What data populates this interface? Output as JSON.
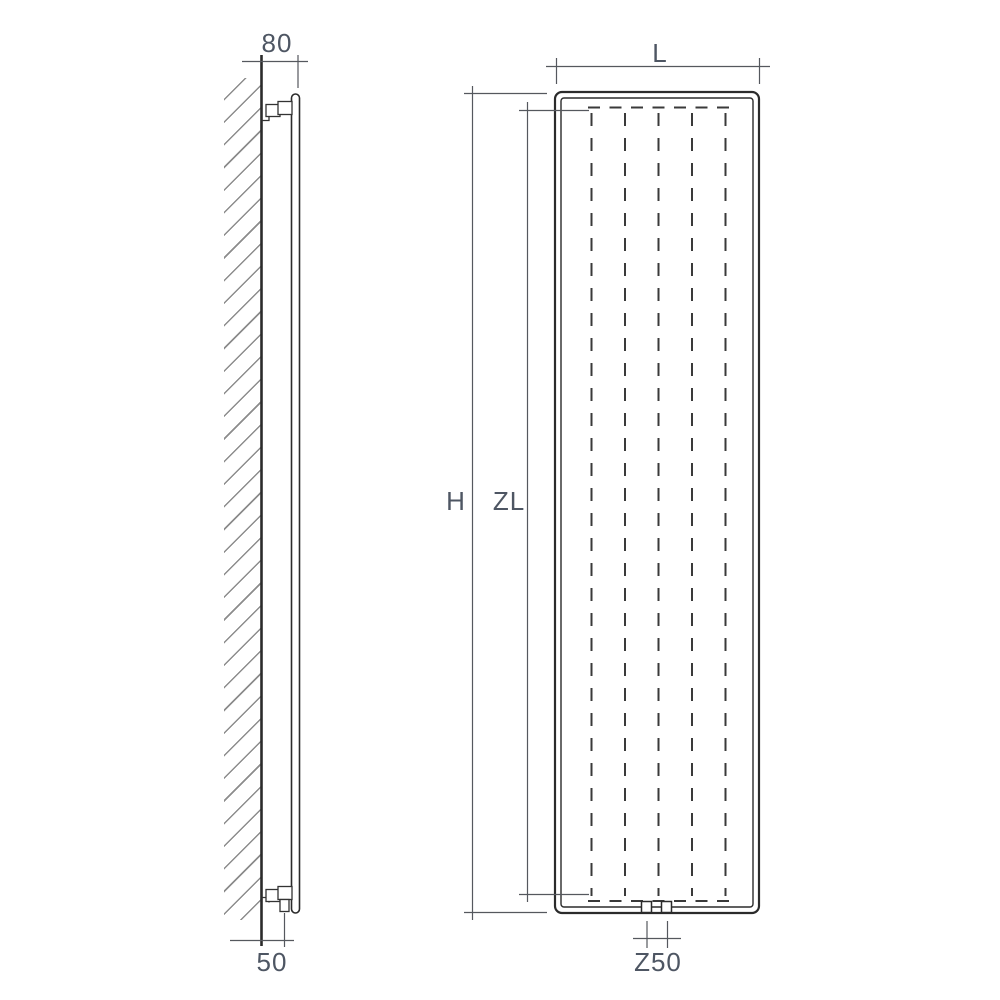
{
  "drawing": {
    "side_view": {
      "top_offset_label": "80",
      "bottom_offset_label": "50"
    },
    "front_view": {
      "width_label": "L",
      "height_label": "H",
      "lamella_height_label": "ZL",
      "connection_spacing_label": "Z50"
    },
    "colors": {
      "outline": "#2b2b2b",
      "dimension_line": "#55585e",
      "label_text": "#4e5663",
      "hatch": "#8c8c8c",
      "background": "#ffffff"
    }
  }
}
